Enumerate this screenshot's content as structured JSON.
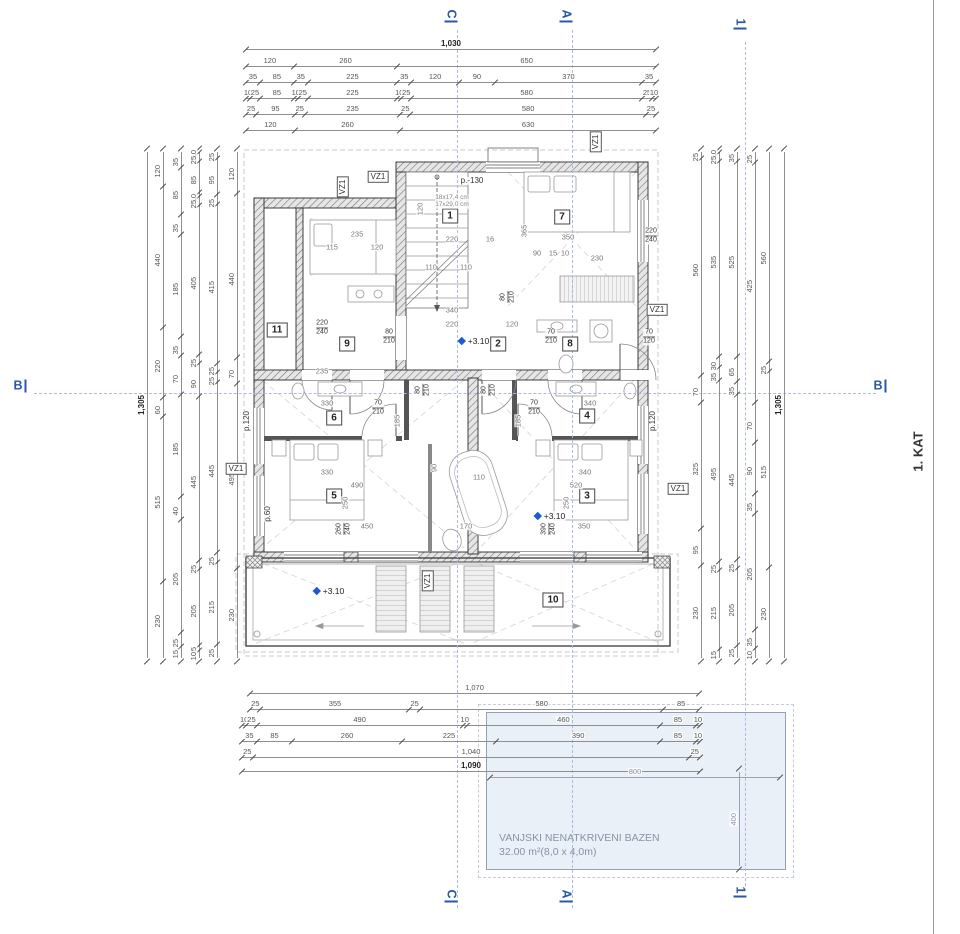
{
  "floor_label": "1. KAT",
  "pool": {
    "label_line1": "VANJSKI NENATKRIVENI BAZEN",
    "label_line2": "32.00 m²(8,0 x 4,0m)",
    "width_dim": "800",
    "height_dim": "400"
  },
  "sections": {
    "vlines": [
      {
        "x": 457,
        "y1": 30,
        "y2": 908
      },
      {
        "x": 572,
        "y1": 30,
        "y2": 908
      },
      {
        "x": 745,
        "y1": 42,
        "y2": 886
      }
    ],
    "hline": {
      "y": 393,
      "x1": 34,
      "x2": 876
    },
    "marks": [
      {
        "t": "C",
        "x": 451,
        "y": 16,
        "r": 90
      },
      {
        "t": "A",
        "x": 566,
        "y": 16,
        "r": 90
      },
      {
        "t": "1",
        "x": 740,
        "y": 24,
        "r": 90
      },
      {
        "t": "C",
        "x": 451,
        "y": 896,
        "r": 90
      },
      {
        "t": "A",
        "x": 566,
        "y": 896,
        "r": 90
      },
      {
        "t": "1",
        "x": 740,
        "y": 892,
        "r": 90
      },
      {
        "t": "B",
        "x": 20,
        "y": 386,
        "r": 0
      },
      {
        "t": "B",
        "x": 880,
        "y": 386,
        "r": 0
      }
    ]
  },
  "dims": {
    "top": {
      "x": 246,
      "w": 410,
      "rows": [
        {
          "y": 38,
          "values": [
            "1,030"
          ],
          "bold": true
        },
        {
          "y": 55,
          "values": [
            "120",
            "260",
            "650"
          ]
        },
        {
          "y": 71,
          "values": [
            "35",
            "85",
            "35",
            "225",
            "35",
            "120",
            "90",
            "370",
            "35"
          ]
        },
        {
          "y": 87,
          "values": [
            "10",
            "25",
            "85",
            "10",
            "25",
            "225",
            "10",
            "25",
            "580",
            "25",
            "10"
          ]
        },
        {
          "y": 103,
          "values": [
            "25",
            "95",
            "25",
            "235",
            "25",
            "580",
            "25"
          ]
        },
        {
          "y": 119,
          "values": [
            "120",
            "260",
            "630"
          ]
        }
      ]
    },
    "bottom": {
      "x": 242,
      "w": 458,
      "rows": [
        {
          "y": 682,
          "x": 250,
          "w": 449,
          "values": [
            "1,070"
          ]
        },
        {
          "y": 698,
          "x": 250,
          "w": 449,
          "values": [
            "25",
            "355",
            "25",
            "580",
            "85"
          ]
        },
        {
          "y": 714,
          "values": [
            "10",
            "25",
            "490",
            "10",
            "460",
            "85",
            "10"
          ]
        },
        {
          "y": 730,
          "values": [
            "35",
            "85",
            "260",
            "225",
            "390",
            "85",
            "10"
          ]
        },
        {
          "y": 746,
          "values": [
            "25",
            "1,040",
            "25"
          ]
        },
        {
          "y": 760,
          "values": [
            "1,090"
          ],
          "bold": true
        }
      ]
    },
    "left": {
      "y": 152,
      "h": 506,
      "cols": [
        {
          "x": 136,
          "values": [
            "1,305"
          ],
          "bold": true
        },
        {
          "x": 152,
          "values": [
            "120",
            "440",
            "220",
            "60",
            "515",
            "230"
          ]
        },
        {
          "x": 170,
          "values": [
            "35",
            "85",
            "35",
            "185",
            "35",
            "70",
            "185",
            "40",
            "205",
            "25",
            "15"
          ]
        },
        {
          "x": 188,
          "values": [
            "10",
            "25",
            "85",
            "10",
            "25",
            "405",
            "25",
            "90",
            "445",
            "25",
            "205",
            "15",
            "10"
          ]
        },
        {
          "x": 206,
          "values": [
            "25",
            "95",
            "25",
            "415",
            "25",
            "25",
            "445",
            "25",
            "215",
            "25"
          ]
        },
        {
          "x": 226,
          "values": [
            "120",
            "440",
            "70",
            "495",
            "230"
          ]
        }
      ]
    },
    "right": {
      "y": 152,
      "h": 506,
      "cols": [
        {
          "x": 690,
          "values": [
            "25",
            "560",
            "70",
            "325",
            "95",
            "230"
          ]
        },
        {
          "x": 708,
          "values": [
            "10",
            "25",
            "535",
            "30",
            "35",
            "495",
            "25",
            "215",
            "15"
          ]
        },
        {
          "x": 726,
          "values": [
            "35",
            "525",
            "65",
            "35",
            "445",
            "25",
            "205",
            "25"
          ]
        },
        {
          "x": 744,
          "values": [
            "25",
            "425",
            "70",
            "90",
            "35",
            "205",
            "35",
            "10"
          ]
        },
        {
          "x": 758,
          "values": [
            "560",
            "25",
            "515",
            "230"
          ]
        },
        {
          "x": 773,
          "values": [
            "1,305"
          ],
          "bold": true
        }
      ]
    },
    "pool_w": {
      "x": 490,
      "y": 766,
      "w": 290,
      "values": [
        "800"
      ]
    },
    "pool_h": {
      "x": 728,
      "y": 772,
      "h": 94,
      "values": [
        "400"
      ]
    }
  },
  "annotations": [
    {
      "k": "room",
      "x": 450,
      "y": 216,
      "t": "1"
    },
    {
      "k": "room",
      "x": 498,
      "y": 344,
      "t": "2"
    },
    {
      "k": "room",
      "x": 587,
      "y": 496,
      "t": "3"
    },
    {
      "k": "room",
      "x": 587,
      "y": 416,
      "t": "4"
    },
    {
      "k": "room",
      "x": 334,
      "y": 496,
      "t": "5"
    },
    {
      "k": "room",
      "x": 334,
      "y": 418,
      "t": "6"
    },
    {
      "k": "room",
      "x": 562,
      "y": 217,
      "t": "7"
    },
    {
      "k": "room",
      "x": 570,
      "y": 344,
      "t": "8"
    },
    {
      "k": "room",
      "x": 347,
      "y": 344,
      "t": "9"
    },
    {
      "k": "room",
      "x": 553,
      "y": 600,
      "t": "10"
    },
    {
      "k": "room",
      "x": 277,
      "y": 330,
      "t": "11"
    },
    {
      "k": "vz",
      "x": 378,
      "y": 177,
      "t": "VZ1"
    },
    {
      "k": "vz",
      "x": 343,
      "y": 187,
      "t": "VZ1",
      "r": 90
    },
    {
      "k": "vz",
      "x": 596,
      "y": 142,
      "t": "VZ1",
      "r": 90
    },
    {
      "k": "vz",
      "x": 657,
      "y": 310,
      "t": "VZ1"
    },
    {
      "k": "vz",
      "x": 236,
      "y": 469,
      "t": "VZ1"
    },
    {
      "k": "vz",
      "x": 678,
      "y": 489,
      "t": "VZ1"
    },
    {
      "k": "vz",
      "x": 428,
      "y": 581,
      "t": "VZ1",
      "r": 90
    },
    {
      "k": "elev",
      "x": 474,
      "y": 341,
      "t": "+3.10"
    },
    {
      "k": "elev",
      "x": 550,
      "y": 516,
      "t": "+3.10"
    },
    {
      "k": "elev",
      "x": 329,
      "y": 591,
      "t": "+3.10"
    },
    {
      "k": "pl",
      "x": 472,
      "y": 181,
      "t": "p.-130"
    },
    {
      "k": "pl",
      "x": 247,
      "y": 421,
      "t": "p.120",
      "r": 90
    },
    {
      "k": "pl",
      "x": 653,
      "y": 421,
      "t": "p.120",
      "r": 90
    },
    {
      "k": "pl",
      "x": 268,
      "y": 514,
      "t": "p.60",
      "r": 90
    },
    {
      "k": "frac",
      "x": 389,
      "y": 337,
      "t": "80|210"
    },
    {
      "k": "frac",
      "x": 551,
      "y": 337,
      "t": "70|210"
    },
    {
      "k": "frac",
      "x": 649,
      "y": 337,
      "t": "70|120"
    },
    {
      "k": "frac",
      "x": 378,
      "y": 408,
      "t": "70|210"
    },
    {
      "k": "frac",
      "x": 534,
      "y": 408,
      "t": "70|210"
    },
    {
      "k": "frac",
      "x": 423,
      "y": 390,
      "t": "80|210",
      "r": 90
    },
    {
      "k": "frac",
      "x": 489,
      "y": 390,
      "t": "80|210",
      "r": 90
    },
    {
      "k": "frac",
      "x": 508,
      "y": 297,
      "t": "80|210",
      "r": 90
    },
    {
      "k": "frac",
      "x": 322,
      "y": 328,
      "t": "220|240"
    },
    {
      "k": "frac",
      "x": 651,
      "y": 236,
      "t": "220|240"
    },
    {
      "k": "frac",
      "x": 344,
      "y": 529,
      "t": "260|240",
      "r": 90
    },
    {
      "k": "frac",
      "x": 549,
      "y": 529,
      "t": "390|240",
      "r": 90
    },
    {
      "k": "tiny",
      "x": 452,
      "y": 198,
      "t": "18x17,4 cm"
    },
    {
      "k": "tiny",
      "x": 452,
      "y": 205,
      "t": "17x29,0 cm"
    },
    {
      "k": "dim",
      "x": 452,
      "y": 239,
      "t": "220"
    },
    {
      "k": "dim",
      "x": 490,
      "y": 239,
      "t": "16"
    },
    {
      "k": "dim",
      "x": 431,
      "y": 267,
      "t": "110"
    },
    {
      "k": "dim",
      "x": 466,
      "y": 267,
      "t": "110"
    },
    {
      "k": "dim",
      "x": 452,
      "y": 310,
      "t": "340"
    },
    {
      "k": "dim",
      "x": 420,
      "y": 209,
      "t": "120",
      "r": 90
    },
    {
      "k": "dim",
      "x": 568,
      "y": 237,
      "t": "350"
    },
    {
      "k": "dim",
      "x": 597,
      "y": 258,
      "t": "230"
    },
    {
      "k": "dim",
      "x": 524,
      "y": 231,
      "t": "365",
      "r": 90
    },
    {
      "k": "dim",
      "x": 537,
      "y": 253,
      "t": "90"
    },
    {
      "k": "dim",
      "x": 553,
      "y": 253,
      "t": "15"
    },
    {
      "k": "dim",
      "x": 565,
      "y": 253,
      "t": "10"
    },
    {
      "k": "dim",
      "x": 357,
      "y": 234,
      "t": "235"
    },
    {
      "k": "dim",
      "x": 332,
      "y": 247,
      "t": "115"
    },
    {
      "k": "dim",
      "x": 377,
      "y": 247,
      "t": "120"
    },
    {
      "k": "dim",
      "x": 322,
      "y": 371,
      "t": "235"
    },
    {
      "k": "dim",
      "x": 452,
      "y": 324,
      "t": "220"
    },
    {
      "k": "dim",
      "x": 512,
      "y": 324,
      "t": "120"
    },
    {
      "k": "dim",
      "x": 327,
      "y": 403,
      "t": "330"
    },
    {
      "k": "dim",
      "x": 590,
      "y": 403,
      "t": "340"
    },
    {
      "k": "dim",
      "x": 327,
      "y": 472,
      "t": "330"
    },
    {
      "k": "dim",
      "x": 357,
      "y": 485,
      "t": "490"
    },
    {
      "k": "dim",
      "x": 367,
      "y": 526,
      "t": "450"
    },
    {
      "k": "dim",
      "x": 345,
      "y": 503,
      "t": "250",
      "r": 90
    },
    {
      "k": "dim",
      "x": 585,
      "y": 472,
      "t": "340"
    },
    {
      "k": "dim",
      "x": 576,
      "y": 485,
      "t": "520"
    },
    {
      "k": "dim",
      "x": 584,
      "y": 526,
      "t": "350"
    },
    {
      "k": "dim",
      "x": 566,
      "y": 503,
      "t": "250",
      "r": 90
    },
    {
      "k": "dim",
      "x": 479,
      "y": 477,
      "t": "110"
    },
    {
      "k": "dim",
      "x": 466,
      "y": 526,
      "t": "170"
    },
    {
      "k": "dim",
      "x": 434,
      "y": 468,
      "t": "90",
      "r": 90
    },
    {
      "k": "dim",
      "x": 397,
      "y": 421,
      "t": "185",
      "r": 90
    },
    {
      "k": "dim",
      "x": 518,
      "y": 421,
      "t": "185",
      "r": 90
    }
  ]
}
